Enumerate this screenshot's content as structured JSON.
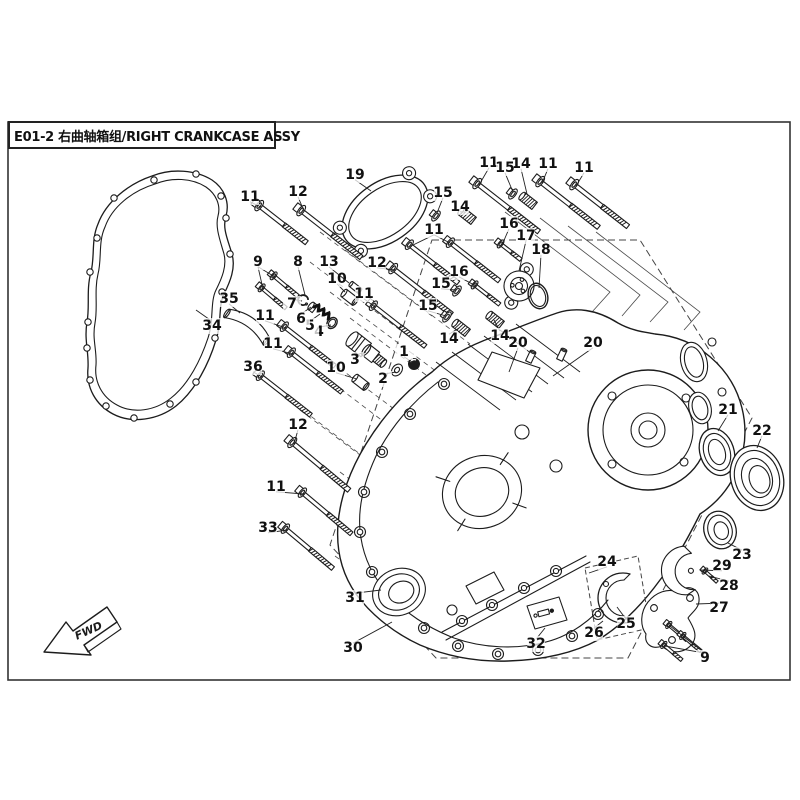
{
  "title": {
    "code": "E01-2",
    "zh": "右曲轴箱组",
    "en": "RIGHT CRANKCASE ASSY",
    "full": "E01-2 右曲轴箱组/RIGHT CRANKCASE ASSY"
  },
  "fwd_label": "FWD",
  "colors": {
    "line": "#1c1c1c",
    "thin": "#3a3a3a",
    "bg": "#ffffff"
  },
  "callouts": [
    {
      "n": "1",
      "x": 404,
      "y": 352,
      "t": [
        [
          412,
          362
        ]
      ]
    },
    {
      "n": "2",
      "x": 383,
      "y": 379,
      "t": [
        [
          396,
          372
        ]
      ]
    },
    {
      "n": "3",
      "x": 355,
      "y": 360,
      "t": [
        [
          366,
          352
        ]
      ]
    },
    {
      "n": "4",
      "x": 319,
      "y": 332,
      "t": [
        [
          331,
          325
        ]
      ]
    },
    {
      "n": "5",
      "x": 310,
      "y": 326,
      "t": [
        [
          320,
          314
        ]
      ]
    },
    {
      "n": "6",
      "x": 301,
      "y": 319,
      "t": [
        [
          311,
          307
        ]
      ]
    },
    {
      "n": "7",
      "x": 292,
      "y": 304,
      "t": [
        [
          302,
          301
        ]
      ]
    },
    {
      "n": "8",
      "x": 298,
      "y": 262,
      "t": [
        [
          305,
          295
        ]
      ]
    },
    {
      "n": "9",
      "x": 258,
      "y": 262,
      "t": [
        [
          275,
          277
        ],
        [
          263,
          289
        ]
      ]
    },
    {
      "n": "9",
      "x": 705,
      "y": 658,
      "t": [
        [
          670,
          626
        ],
        [
          684,
          637
        ],
        [
          665,
          646
        ]
      ]
    },
    {
      "n": "10",
      "x": 337,
      "y": 279,
      "t": [
        [
          345,
          292
        ]
      ]
    },
    {
      "n": "10",
      "x": 336,
      "y": 368,
      "t": [
        [
          357,
          379
        ]
      ]
    },
    {
      "n": "11",
      "x": 250,
      "y": 197,
      "t": [
        [
          261,
          207
        ]
      ]
    },
    {
      "n": "11",
      "x": 489,
      "y": 163,
      "t": [
        [
          479,
          185
        ]
      ]
    },
    {
      "n": "11",
      "x": 548,
      "y": 164,
      "t": [
        [
          542,
          183
        ]
      ]
    },
    {
      "n": "11",
      "x": 584,
      "y": 168,
      "t": [
        [
          576,
          186
        ]
      ]
    },
    {
      "n": "11",
      "x": 434,
      "y": 230,
      "t": [
        [
          411,
          246
        ],
        [
          452,
          244
        ]
      ]
    },
    {
      "n": "11",
      "x": 364,
      "y": 294,
      "t": [
        [
          375,
          307
        ]
      ]
    },
    {
      "n": "11",
      "x": 265,
      "y": 316,
      "t": [
        [
          286,
          328
        ]
      ]
    },
    {
      "n": "11",
      "x": 273,
      "y": 344,
      "t": [
        [
          293,
          354
        ]
      ]
    },
    {
      "n": "11",
      "x": 276,
      "y": 487,
      "t": [
        [
          304,
          494
        ]
      ]
    },
    {
      "n": "12",
      "x": 298,
      "y": 192,
      "t": [
        [
          304,
          211
        ]
      ]
    },
    {
      "n": "12",
      "x": 377,
      "y": 263,
      "t": [
        [
          395,
          270
        ]
      ]
    },
    {
      "n": "12",
      "x": 298,
      "y": 425,
      "t": [
        [
          294,
          444
        ]
      ]
    },
    {
      "n": "13",
      "x": 329,
      "y": 262,
      "t": [
        [
          349,
          283
        ]
      ]
    },
    {
      "n": "14",
      "x": 521,
      "y": 164,
      "t": [
        [
          527,
          194
        ]
      ]
    },
    {
      "n": "14",
      "x": 460,
      "y": 207,
      "t": [
        [
          465,
          212
        ]
      ]
    },
    {
      "n": "14",
      "x": 449,
      "y": 339,
      "t": [
        [
          459,
          328
        ]
      ]
    },
    {
      "n": "14",
      "x": 500,
      "y": 336,
      "t": [
        [
          494,
          320
        ]
      ]
    },
    {
      "n": "15",
      "x": 505,
      "y": 168,
      "t": [
        [
          513,
          192
        ]
      ]
    },
    {
      "n": "15",
      "x": 443,
      "y": 193,
      "t": [
        [
          437,
          213
        ]
      ]
    },
    {
      "n": "15",
      "x": 441,
      "y": 284,
      "t": [
        [
          456,
          290
        ]
      ]
    },
    {
      "n": "15",
      "x": 428,
      "y": 306,
      "t": [
        [
          446,
          316
        ]
      ]
    },
    {
      "n": "16",
      "x": 509,
      "y": 224,
      "t": [
        [
          502,
          245
        ]
      ]
    },
    {
      "n": "16",
      "x": 459,
      "y": 272,
      "t": [
        [
          476,
          286
        ]
      ]
    },
    {
      "n": "17",
      "x": 526,
      "y": 236,
      "t": [
        [
          519,
          271
        ]
      ]
    },
    {
      "n": "18",
      "x": 541,
      "y": 250,
      "t": [
        [
          539,
          288
        ]
      ]
    },
    {
      "n": "19",
      "x": 355,
      "y": 175,
      "t": [
        [
          371,
          191
        ]
      ]
    },
    {
      "n": "20",
      "x": 518,
      "y": 343,
      "t": [
        [
          509,
          372
        ]
      ]
    },
    {
      "n": "20",
      "x": 593,
      "y": 343,
      "t": [
        [
          553,
          376
        ]
      ]
    },
    {
      "n": "21",
      "x": 728,
      "y": 410,
      "t": [
        [
          718,
          431
        ]
      ]
    },
    {
      "n": "22",
      "x": 762,
      "y": 431,
      "t": [
        [
          757,
          448
        ]
      ]
    },
    {
      "n": "23",
      "x": 742,
      "y": 555,
      "t": [
        [
          728,
          543
        ]
      ]
    },
    {
      "n": "24",
      "x": 607,
      "y": 562,
      "t": [
        [
          589,
          573
        ]
      ]
    },
    {
      "n": "25",
      "x": 626,
      "y": 624,
      "t": [
        [
          617,
          607
        ]
      ]
    },
    {
      "n": "26",
      "x": 594,
      "y": 633,
      "t": [
        [
          603,
          621
        ]
      ]
    },
    {
      "n": "27",
      "x": 719,
      "y": 608,
      "t": [
        [
          696,
          604
        ]
      ]
    },
    {
      "n": "28",
      "x": 729,
      "y": 586,
      "t": [
        [
          709,
          576
        ]
      ]
    },
    {
      "n": "29",
      "x": 722,
      "y": 566,
      "t": [
        [
          700,
          570
        ]
      ]
    },
    {
      "n": "30",
      "x": 353,
      "y": 648,
      "t": [
        [
          392,
          622
        ]
      ]
    },
    {
      "n": "31",
      "x": 355,
      "y": 598,
      "t": [
        [
          381,
          590
        ]
      ]
    },
    {
      "n": "32",
      "x": 536,
      "y": 644,
      "t": [
        [
          545,
          628
        ]
      ]
    },
    {
      "n": "33",
      "x": 268,
      "y": 528,
      "t": [
        [
          287,
          530
        ]
      ]
    },
    {
      "n": "34",
      "x": 212,
      "y": 326,
      "t": [
        [
          196,
          310
        ]
      ]
    },
    {
      "n": "35",
      "x": 229,
      "y": 299,
      "t": [
        [
          240,
          313
        ]
      ]
    },
    {
      "n": "36",
      "x": 253,
      "y": 367,
      "t": [
        [
          262,
          377
        ]
      ]
    }
  ],
  "parts": [
    {
      "type": "bolt",
      "x": 261,
      "y": 207,
      "a": 38,
      "len": 58,
      "s": 6.5
    },
    {
      "type": "bolt",
      "x": 303,
      "y": 212,
      "a": 38,
      "len": 74,
      "s": 6.5
    },
    {
      "type": "bolt",
      "x": 411,
      "y": 246,
      "a": 38,
      "len": 60,
      "s": 6
    },
    {
      "type": "bolt",
      "x": 452,
      "y": 244,
      "a": 38,
      "len": 60,
      "s": 6
    },
    {
      "type": "bolt",
      "x": 479,
      "y": 185,
      "a": 38,
      "len": 76,
      "s": 6.5
    },
    {
      "type": "bolt",
      "x": 542,
      "y": 183,
      "a": 38,
      "len": 72,
      "s": 6.5
    },
    {
      "type": "bolt",
      "x": 576,
      "y": 186,
      "a": 38,
      "len": 66,
      "s": 6.5
    },
    {
      "type": "bolt",
      "x": 395,
      "y": 270,
      "a": 38,
      "len": 72,
      "s": 6.5
    },
    {
      "type": "bolt",
      "x": 375,
      "y": 307,
      "a": 38,
      "len": 64,
      "s": 6
    },
    {
      "type": "bolt",
      "x": 286,
      "y": 328,
      "a": 38,
      "len": 62,
      "s": 6
    },
    {
      "type": "bolt",
      "x": 293,
      "y": 354,
      "a": 38,
      "len": 62,
      "s": 6
    },
    {
      "type": "bolt",
      "x": 262,
      "y": 377,
      "a": 38,
      "len": 62,
      "s": 6
    },
    {
      "type": "bolt",
      "x": 294,
      "y": 444,
      "a": 40,
      "len": 72,
      "s": 6.5
    },
    {
      "type": "bolt",
      "x": 304,
      "y": 494,
      "a": 40,
      "len": 62,
      "s": 6
    },
    {
      "type": "bolt",
      "x": 287,
      "y": 530,
      "a": 40,
      "len": 60,
      "s": 6
    },
    {
      "type": "bolt",
      "x": 275,
      "y": 277,
      "a": 40,
      "len": 30,
      "s": 5
    },
    {
      "type": "bolt",
      "x": 263,
      "y": 289,
      "a": 40,
      "len": 30,
      "s": 5
    },
    {
      "type": "bolt",
      "x": 502,
      "y": 245,
      "a": 38,
      "len": 24,
      "s": 5
    },
    {
      "type": "bolt",
      "x": 476,
      "y": 286,
      "a": 38,
      "len": 30,
      "s": 5
    },
    {
      "type": "bolt",
      "x": 670,
      "y": 626,
      "a": 40,
      "len": 22,
      "s": 4.5
    },
    {
      "type": "bolt",
      "x": 684,
      "y": 637,
      "a": 40,
      "len": 22,
      "s": 4.5
    },
    {
      "type": "bolt",
      "x": 665,
      "y": 646,
      "a": 40,
      "len": 22,
      "s": 4.5
    },
    {
      "type": "bolt",
      "x": 706,
      "y": 572,
      "a": 42,
      "len": 15,
      "s": 4
    },
    {
      "type": "nut",
      "x": 513,
      "y": 194,
      "a": 38,
      "s": 6
    },
    {
      "type": "nut",
      "x": 436,
      "y": 216,
      "a": 38,
      "s": 6
    },
    {
      "type": "nut",
      "x": 457,
      "y": 291,
      "a": 38,
      "s": 6
    },
    {
      "type": "nut",
      "x": 447,
      "y": 317,
      "a": 38,
      "s": 6
    },
    {
      "type": "stud",
      "x": 522,
      "y": 196,
      "a": 38,
      "len": 16,
      "r": 4.5
    },
    {
      "type": "stud",
      "x": 461,
      "y": 211,
      "a": 38,
      "len": 16,
      "r": 4.5
    },
    {
      "type": "stud",
      "x": 455,
      "y": 323,
      "a": 38,
      "len": 16,
      "r": 4.5
    },
    {
      "type": "stud",
      "x": 489,
      "y": 315,
      "a": 38,
      "len": 16,
      "r": 4.5
    },
    {
      "type": "dowel",
      "x": 344,
      "y": 293,
      "a": 38,
      "len": 14,
      "r": 4.5
    },
    {
      "type": "dowel",
      "x": 355,
      "y": 378,
      "a": 38,
      "len": 14,
      "r": 4.5
    },
    {
      "type": "dowel",
      "x": 351,
      "y": 284,
      "a": 38,
      "len": 11,
      "r": 3
    },
    {
      "type": "pin",
      "x": 533,
      "y": 352,
      "a": 115,
      "len": 11,
      "r": 3
    },
    {
      "type": "pin",
      "x": 564,
      "y": 350,
      "a": 115,
      "len": 11,
      "r": 3
    },
    {
      "type": "circlip",
      "x": 303,
      "y": 300
    },
    {
      "type": "cap",
      "x": 311,
      "y": 306
    },
    {
      "type": "spring",
      "x": 314,
      "y": 307
    },
    {
      "type": "oring",
      "x": 332,
      "y": 323,
      "rx": 6,
      "ry": 4.6
    },
    {
      "type": "body3",
      "x": 352,
      "y": 339
    },
    {
      "type": "washer",
      "x": 397,
      "y": 370
    },
    {
      "type": "plug",
      "x": 414,
      "y": 364
    },
    {
      "type": "unit17",
      "x": 519,
      "y": 286
    },
    {
      "type": "oring18",
      "x": 538,
      "y": 296
    },
    {
      "type": "seal21",
      "x": 717,
      "y": 452
    },
    {
      "type": "bearing22",
      "x": 757,
      "y": 478
    },
    {
      "type": "bearing23",
      "x": 720,
      "y": 530
    },
    {
      "type": "fork29",
      "x": 688,
      "y": 570
    },
    {
      "type": "bracket27",
      "x": 0,
      "y": 0
    },
    {
      "type": "part35",
      "x": 246,
      "y": 328
    }
  ]
}
